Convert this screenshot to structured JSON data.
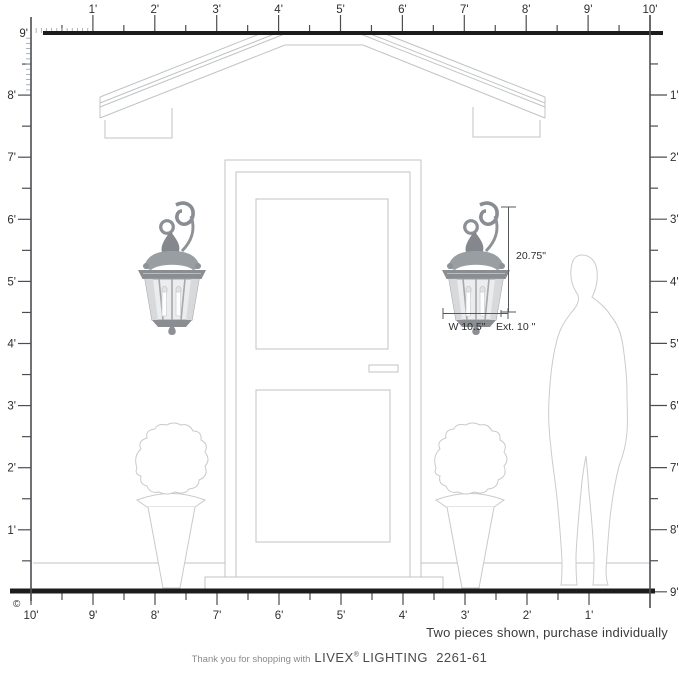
{
  "rulers": {
    "top": {
      "labels": [
        "1'",
        "2'",
        "3'",
        "4'",
        "5'",
        "6'",
        "7'",
        "8'",
        "9'",
        "10'"
      ]
    },
    "left": {
      "labels": [
        "9'",
        "8'",
        "7'",
        "6'",
        "5'",
        "4'",
        "3'",
        "2'",
        "1'"
      ]
    },
    "right": {
      "labels": [
        "1'",
        "2'",
        "3'",
        "4'",
        "5'",
        "6'",
        "7'",
        "8'",
        "9'"
      ]
    },
    "bottom": {
      "labels": [
        "10'",
        "9'",
        "8'",
        "7'",
        "6'",
        "5'",
        "4'",
        "3'",
        "2'",
        "1'"
      ]
    }
  },
  "dimensions": {
    "height": "20.75\"",
    "width": "W 10.5\"",
    "extension": "Ext. 10 \""
  },
  "note": "Two pieces shown, purchase individually",
  "footer": {
    "prefix": "Thank you for shopping with",
    "brand": "LIVEX",
    "registered": "®",
    "product": "LIGHTING  2261-61"
  },
  "copyright": "©",
  "colors": {
    "ink": "#1c1c1c",
    "ruler": "#4b4e52",
    "ruler_minor": "#9aa0a4",
    "drawing": "#bfc3c5",
    "figure": "#cdd0d1",
    "dimension": "#55585b",
    "metal": "#8a8e92",
    "glass": "#ebeced"
  }
}
